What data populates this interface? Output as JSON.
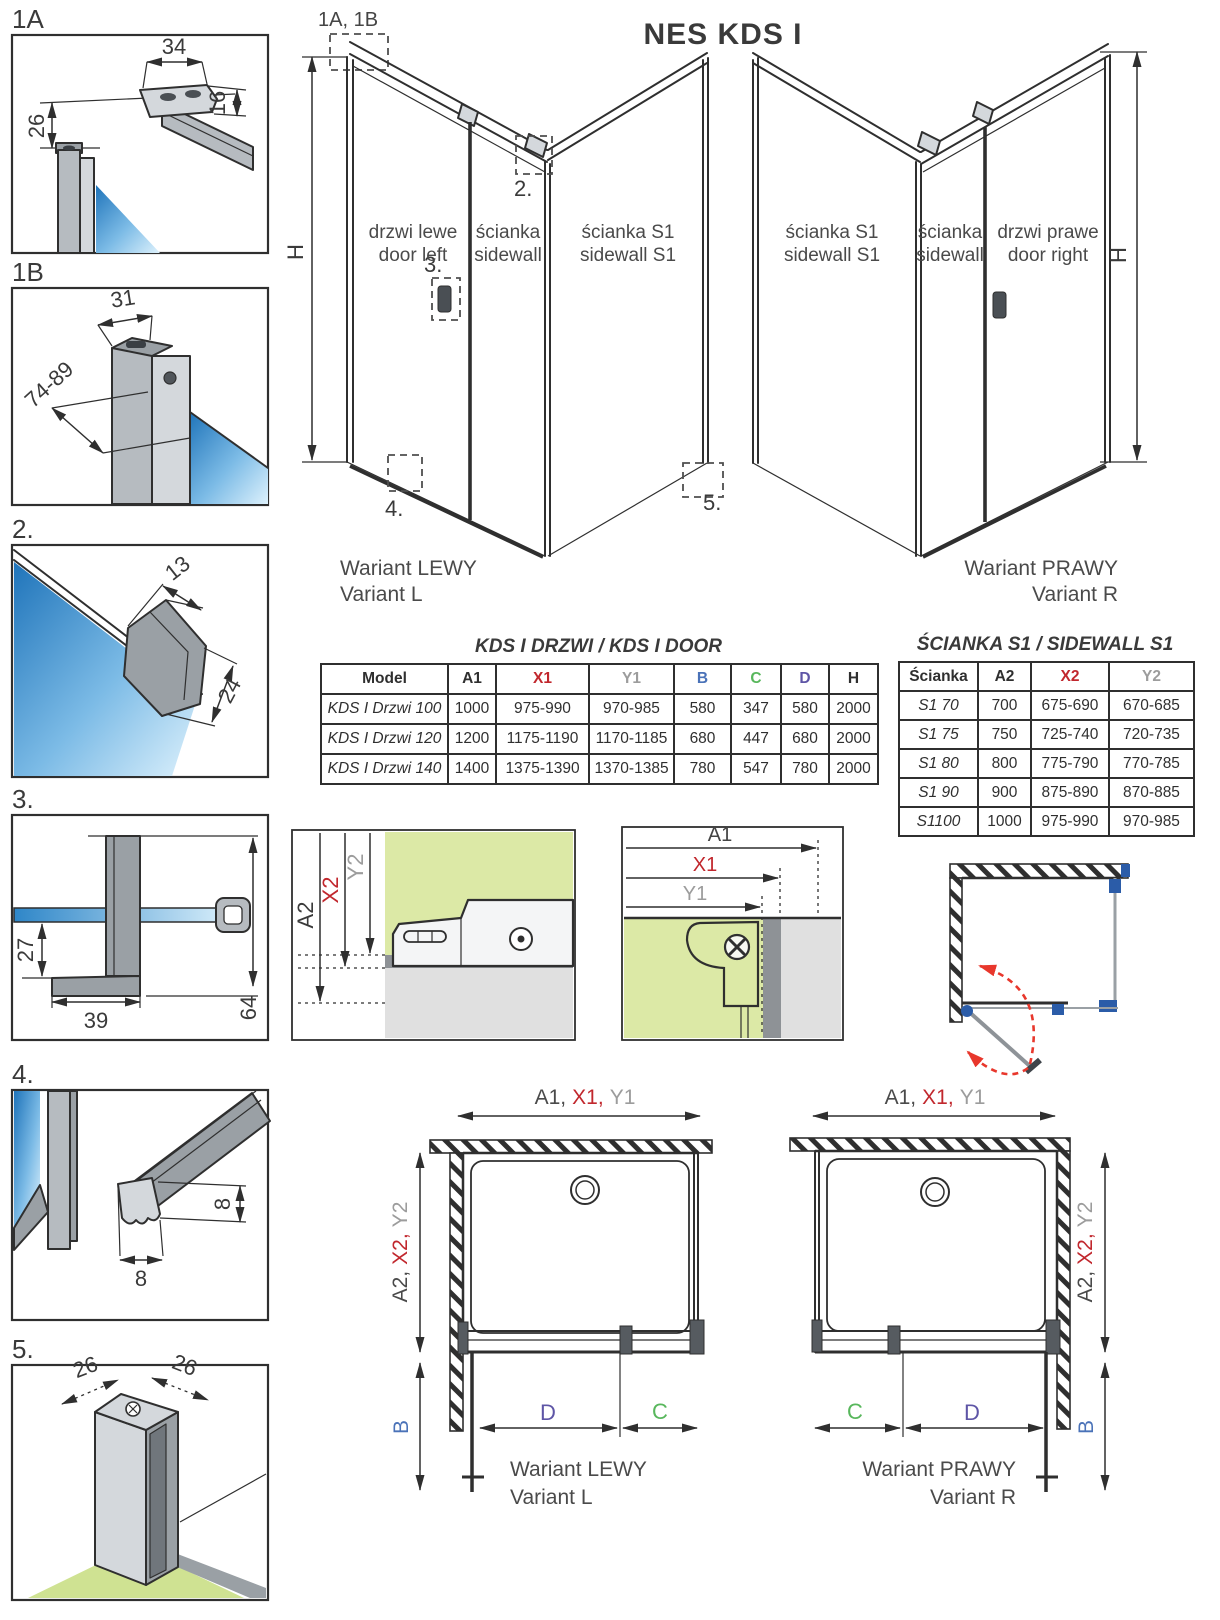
{
  "title": "NES KDS I",
  "details": {
    "d1a": {
      "label": "1A",
      "dim_top": "34",
      "dim_right": "16",
      "dim_left": "26"
    },
    "d1b": {
      "label": "1B",
      "dim_top": "31",
      "dim_diag": "74-89"
    },
    "d2": {
      "label": "2.",
      "dim_top": "13",
      "dim_side": "24"
    },
    "d3": {
      "label": "3.",
      "dim_left": "27",
      "dim_bottom": "39",
      "dim_right": "64"
    },
    "d4": {
      "label": "4.",
      "dim_height": "8",
      "dim_width": "8"
    },
    "d5": {
      "label": "5.",
      "dim_left": "26",
      "dim_right": "26"
    }
  },
  "iso_left": {
    "ref_label": "1A, 1B",
    "h_label": "H",
    "marker_2": "2.",
    "marker_3": "3.",
    "marker_4": "4.",
    "marker_5": "5.",
    "door_line1": "drzwi lewe",
    "door_line2": "door left",
    "side_line1": "ścianka",
    "side_line2": "sidewall",
    "s1_line1": "ścianka S1",
    "s1_line2": "sidewall S1",
    "caption_line1": "Wariant LEWY",
    "caption_line2": "Variant L"
  },
  "iso_right": {
    "h_label": "H",
    "s1_line1": "ścianka S1",
    "s1_line2": "sidewall S1",
    "side_line1": "ścianka",
    "side_line2": "sidewall",
    "door_line1": "drzwi prawe",
    "door_line2": "door right",
    "caption_line1": "Wariant PRAWY",
    "caption_line2": "Variant R"
  },
  "door_table": {
    "title": "KDS I DRZWI / KDS I DOOR",
    "headers": [
      "Model",
      "A1",
      "X1",
      "Y1",
      "B",
      "C",
      "D",
      "H"
    ],
    "rows": [
      [
        "KDS I Drzwi 100",
        "1000",
        "975-990",
        "970-985",
        "580",
        "347",
        "580",
        "2000"
      ],
      [
        "KDS I Drzwi 120",
        "1200",
        "1175-1190",
        "1170-1185",
        "680",
        "447",
        "680",
        "2000"
      ],
      [
        "KDS I Drzwi 140",
        "1400",
        "1375-1390",
        "1370-1385",
        "780",
        "547",
        "780",
        "2000"
      ]
    ]
  },
  "sidewall_table": {
    "title": "ŚCIANKA S1 / SIDEWALL S1",
    "headers": [
      "Ścianka",
      "A2",
      "X2",
      "Y2"
    ],
    "rows": [
      [
        "S1 70",
        "700",
        "675-690",
        "670-685"
      ],
      [
        "S1 75",
        "750",
        "725-740",
        "720-735"
      ],
      [
        "S1 80",
        "800",
        "775-790",
        "770-785"
      ],
      [
        "S1 90",
        "900",
        "875-890",
        "870-885"
      ],
      [
        "S1100",
        "1000",
        "975-990",
        "970-985"
      ]
    ]
  },
  "section_wall": {
    "a2": "A2",
    "x2": "X2",
    "y2": "Y2"
  },
  "section_door": {
    "a1": "A1",
    "x1": "X1",
    "y1": "Y1"
  },
  "plan_left": {
    "a1": "A1,",
    "x1": "X1,",
    "y1": "Y1",
    "a2": "A2,",
    "x2": "X2,",
    "y2": "Y2",
    "b": "B",
    "c": "C",
    "d": "D",
    "caption_line1": "Wariant LEWY",
    "caption_line2": "Variant L"
  },
  "plan_right": {
    "a1": "A1,",
    "x1": "X1,",
    "y1": "Y1",
    "a2": "A2,",
    "x2": "X2,",
    "y2": "Y2",
    "b": "B",
    "c": "C",
    "d": "D",
    "caption_line1": "Wariant PRAWY",
    "caption_line2": "Variant R"
  },
  "colors": {
    "red": "#c1272d",
    "gray": "#9c9c9c",
    "blue": "#4a72b8",
    "green": "#58b75c",
    "indigo": "#5e55a6",
    "ink": "#2f2f2f",
    "glass_green": "#dce9a6",
    "swing_red": "#e8372c",
    "hardware_blue": "#2b5ca8"
  }
}
